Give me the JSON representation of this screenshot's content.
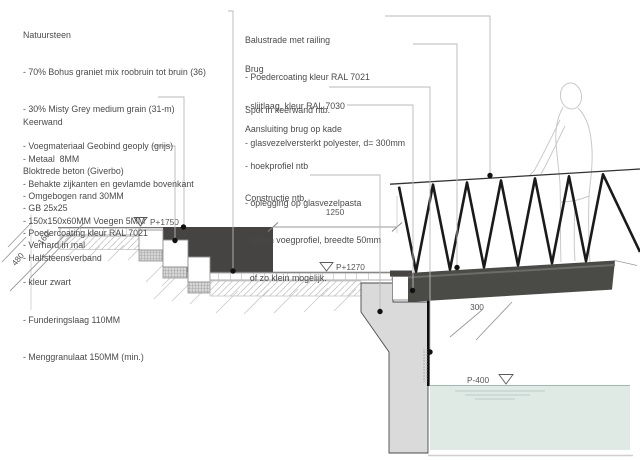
{
  "annotations": {
    "left": [
      {
        "title": "Natuursteen",
        "lines": [
          "- 70% Bohus graniet mix roobruin tot bruin (36)",
          "- 30% Misty Grey medium grain (31-m)",
          "- Voegmateriaal Geobind geoply (grijs)",
          "- Behakte zijkanten en gevlamde bovenkant",
          "- 150x150x60MM Voegen 5MM",
          "- Halfsteensverband"
        ]
      },
      {
        "title": "Keerwand",
        "lines": [
          "- Metaal  8MM",
          "- Omgebogen rand 30MM",
          "- Poedercoating kleur RAL 7021"
        ]
      },
      {
        "title": "Bloktrede beton (Giverbo)",
        "lines": [
          "- GB 25x25",
          "- Verhard in mal",
          "- kleur zwart",
          "- Funderingslaag 110MM",
          "- Menggranulaat 150MM (min.)"
        ]
      }
    ],
    "right": [
      {
        "title": "Balustrade met railing",
        "lines": [
          "- Poedercoating kleur RAL 7021"
        ]
      },
      {
        "title": "Brug",
        "lines": [
          "- slijtlaag, kleur RAL 7030",
          "- glasvezelversterkt polyester, d= 300mm"
        ]
      },
      {
        "title": "Spot in keerwand ntb.",
        "lines": []
      },
      {
        "title": "Aansluiting brug op kade",
        "lines": [
          "- hoekprofiel ntb",
          "- oplegging op glasvezelpasta",
          "- stalen voegprofiel, breedte 50mm",
          "  of zo klein mogelijk."
        ]
      },
      {
        "title": "Constructie ntb.",
        "lines": []
      }
    ]
  },
  "dimensions": {
    "span": "1250",
    "deck_depth": "300",
    "stair_total": "480",
    "riser": "160"
  },
  "levels": {
    "upper": "P+1750",
    "kade": "P+1270",
    "water": "P-400"
  },
  "colors": {
    "keerwand": "#454442",
    "bridge_deck": "#4a4a47",
    "quay_concrete": "#dadada",
    "water": "#dfeae5",
    "railing": "#1a1a1a",
    "annotation_text": "#4a4a4a"
  }
}
